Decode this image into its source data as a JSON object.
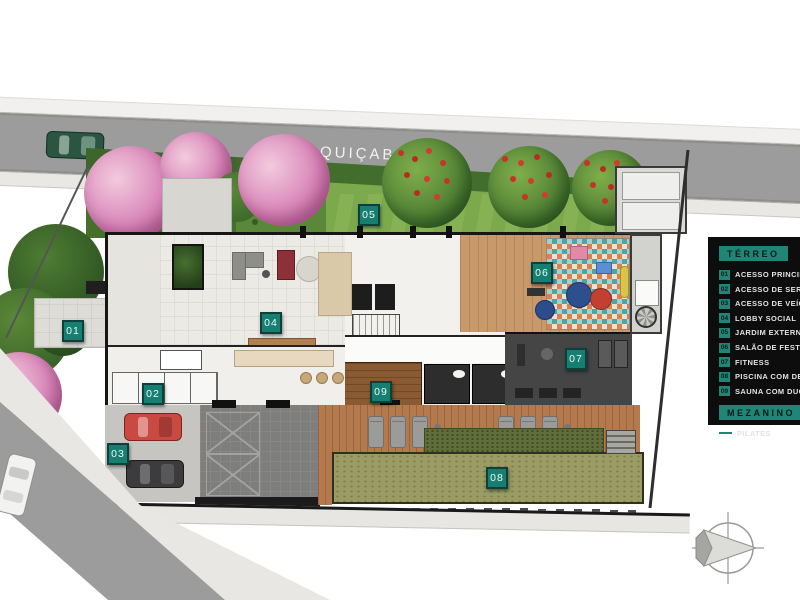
{
  "street": {
    "name": "RUA QUIÇABÁ"
  },
  "plan_markers": [
    "01",
    "02",
    "03",
    "04",
    "05",
    "06",
    "07",
    "08",
    "09"
  ],
  "legend": {
    "sections": [
      {
        "title": "TÉRREO",
        "items": [
          {
            "num": "01",
            "label": "ACESSO PRINCIPAL CO"
          },
          {
            "num": "02",
            "label": "ACESSO DE SERVIÇO"
          },
          {
            "num": "03",
            "label": "ACESSO DE VEÍCULOS"
          },
          {
            "num": "04",
            "label": "LOBBY SOCIAL"
          },
          {
            "num": "05",
            "label": "JARDIM EXTERNO"
          },
          {
            "num": "06",
            "label": "SALÃO DE FESTAS/BRI"
          },
          {
            "num": "07",
            "label": "FITNESS"
          },
          {
            "num": "08",
            "label": "PISCINA COM DECK MO"
          },
          {
            "num": "09",
            "label": "SAUNA COM DUCHA"
          }
        ]
      },
      {
        "title": "MEZANINO",
        "items": [
          {
            "num": "",
            "label": "PILATES"
          }
        ]
      }
    ]
  },
  "colors": {
    "accent_teal": "#1A8173",
    "legend_bg": "#0D0D0E",
    "street_gray": "#9C9C9C",
    "pool_green": "#9A9C64",
    "deck_wood": "#B5794E"
  }
}
